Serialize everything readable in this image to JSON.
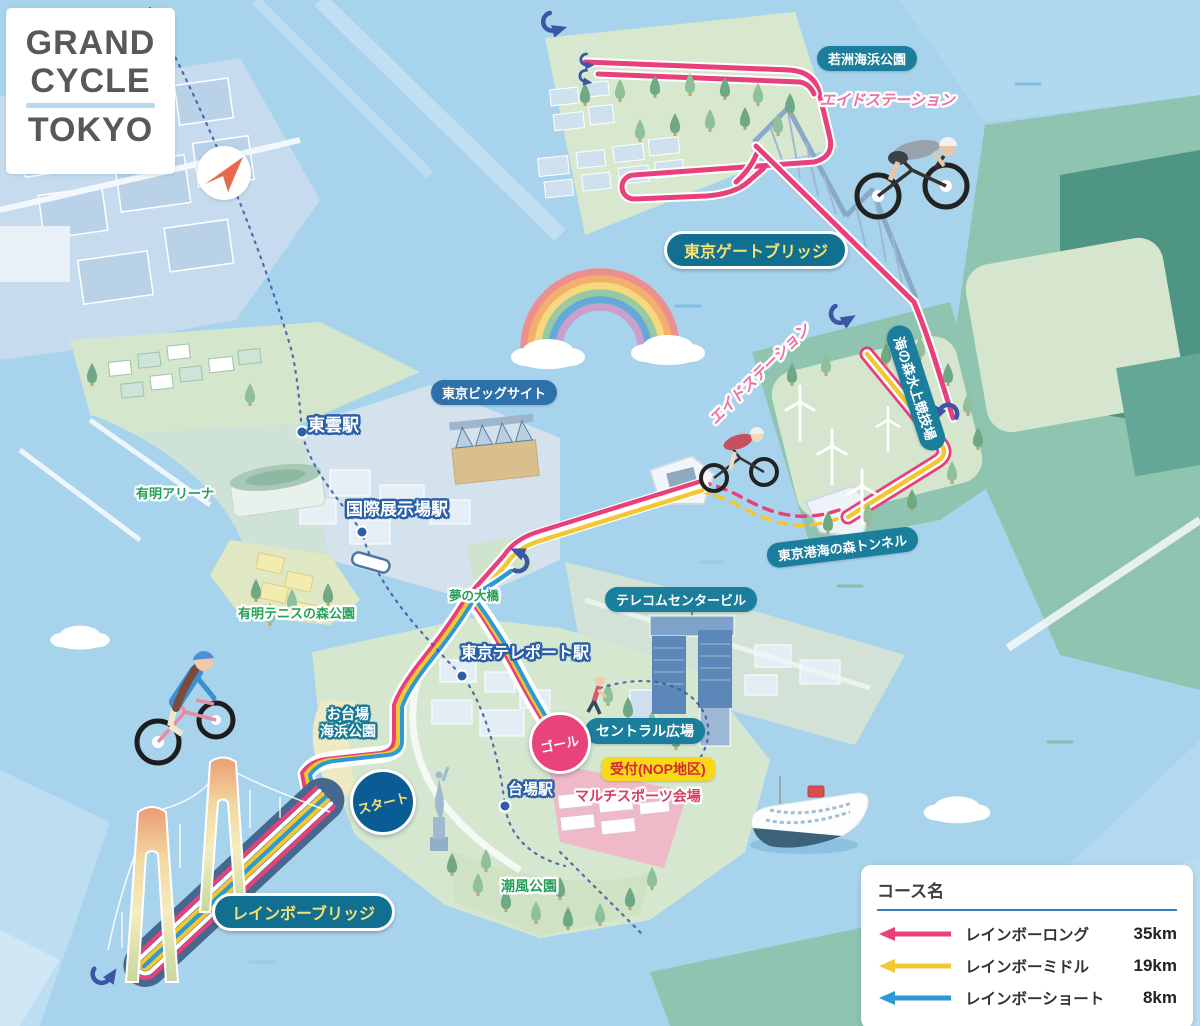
{
  "logo": {
    "line1": "GRAND",
    "line2": "CYCLE",
    "line3": "TOKYO"
  },
  "labels": {
    "wakasu_park": "若洲海浜公園",
    "aid_station_north": "エイドステーション",
    "gate_bridge": "東京ゲートブリッジ",
    "aid_station_east": "エイドステーション",
    "umi_no_mori_stadium": "海の森水上競技場",
    "big_sight": "東京ビッグサイト",
    "shinonome_station": "東雲駅",
    "ariake_arena": "有明アリーナ",
    "kokusai_tenjijo_station": "国際展示場駅",
    "ariake_tennis_park": "有明テニスの森公園",
    "yume_no_ohashi": "夢の大橋",
    "telecom_center": "テレコムセンタービル",
    "umi_tunnel": "東京港海の森トンネル",
    "teleport_station": "東京テレポート駅",
    "odaiba_park_line1": "お台場",
    "odaiba_park_line2": "海浜公園",
    "central_plaza": "セントラル広場",
    "goal": "ゴール",
    "reception": "受付(NOP地区)",
    "start": "スタート",
    "daiba_station": "台場駅",
    "multi_sport_venue": "マルチスポーツ会場",
    "shiokaze_park": "潮風公園",
    "rainbow_bridge": "レインボーブリッジ"
  },
  "legend": {
    "title": "コース名",
    "courses": [
      {
        "name": "レインボーロング",
        "distance": "35km",
        "color": "#e8407a"
      },
      {
        "name": "レインボーミドル",
        "distance": "19km",
        "color": "#f2c832"
      },
      {
        "name": "レインボーショート",
        "distance": "8km",
        "color": "#2d9ad4"
      }
    ]
  },
  "colors": {
    "long": "#e8407a",
    "middle": "#f2c832",
    "short": "#2d9ad4",
    "water": "#a8d3ec"
  }
}
